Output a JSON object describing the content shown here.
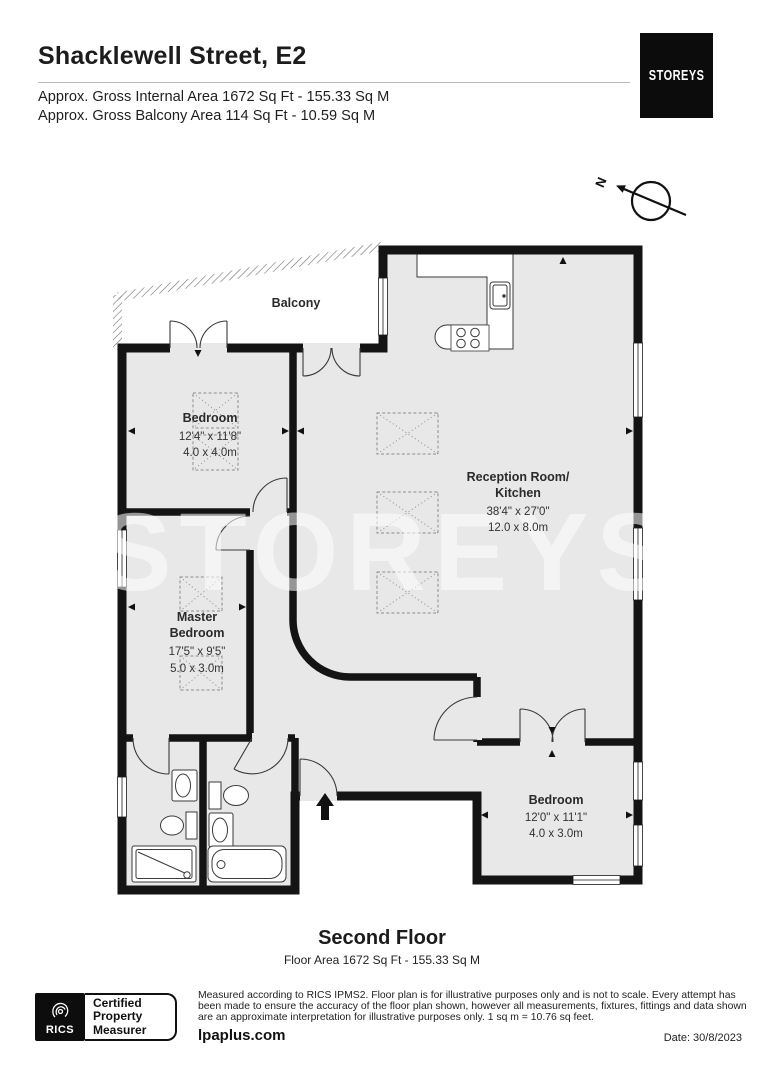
{
  "header": {
    "title": "Shacklewell Street, E2",
    "area_line1": "Approx. Gross Internal Area 1672 Sq Ft - 155.33 Sq M",
    "area_line2": "Approx. Gross Balcony Area 114 Sq Ft - 10.59 Sq M",
    "brand": "STOREYS"
  },
  "compass": {
    "label": "N"
  },
  "floorplan": {
    "watermark": "STOREYS",
    "rooms": [
      {
        "name": "Balcony"
      },
      {
        "name": "Bedroom",
        "imperial": "12'4\" x 11'8\"",
        "metric": "4.0 x 4.0m"
      },
      {
        "line1": "Reception Room/",
        "line2": "Kitchen",
        "imperial": "38'4\" x 27'0\"",
        "metric": "12.0 x 8.0m"
      },
      {
        "line1": "Master",
        "line2": "Bedroom",
        "imperial": "17'5\" x 9'5\"",
        "metric": "5.0 x 3.0m"
      },
      {
        "name": "Bedroom",
        "imperial": "12'0\" x 11'1\"",
        "metric": "4.0 x 3.0m"
      }
    ]
  },
  "floor_label": {
    "title": "Second Floor",
    "subtitle": "Floor Area 1672 Sq Ft - 155.33 Sq M"
  },
  "footer": {
    "rics_word": "RICS",
    "badge_line1": "Certified",
    "badge_line2": "Property",
    "badge_line3": "Measurer",
    "disclaimer": "Measured according to RICS IPMS2. Floor plan is for illustrative purposes only and is not to scale. Every attempt has been made to ensure the accuracy of the floor plan shown, however all measurements, fixtures, fittings and data shown are an approximate interpretation for illustrative purposes only. 1 sq m = 10.76 sq feet.",
    "website": "lpaplus.com",
    "date": "Date: 30/8/2023"
  },
  "colors": {
    "wall": "#141414",
    "floor": "#e8e8e8",
    "brand_bg": "#0c0c0c",
    "text": "#1d1d1d"
  }
}
